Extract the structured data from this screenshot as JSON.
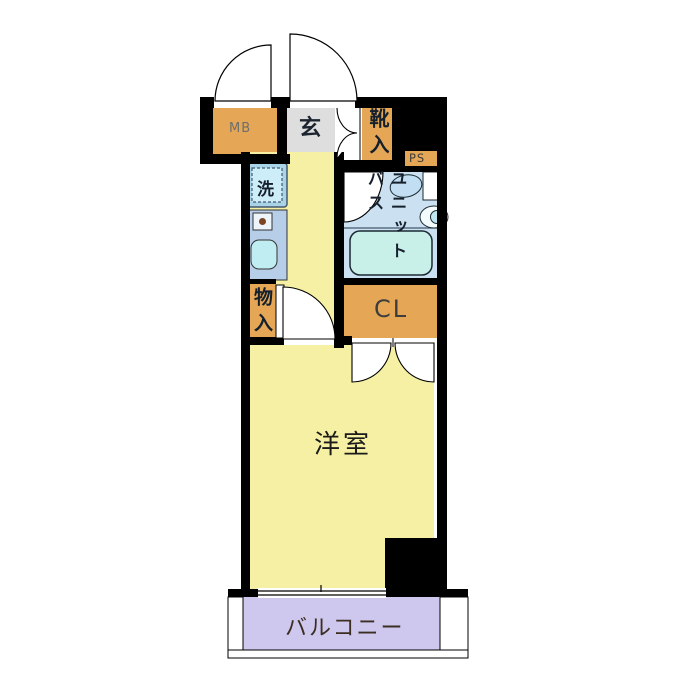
{
  "plan_type": "apartment-floor-plan-1K",
  "labels": {
    "mb": "MB",
    "entrance": "玄",
    "shoe_cabinet": "靴入",
    "pipe_space": "PS",
    "washer": "洗",
    "unit_bath": "ユニットバス",
    "storage": "物入",
    "closet": "CL",
    "western_room": "洋室",
    "balcony": "バルコニー"
  },
  "colors": {
    "wall": "#000000",
    "room_yellow": "#F5F0A3",
    "cabinet_orange": "#E5A756",
    "entrance_gray": "#DEDEDE",
    "bath_blue": "#CBE1F1",
    "tub_cyan": "#C9EFE9",
    "counter_blue": "#B6CEE8",
    "washer_blue": "#A9D4E8",
    "balcony_purple": "#CEC8EE",
    "door_white": "#FFFFFF"
  }
}
